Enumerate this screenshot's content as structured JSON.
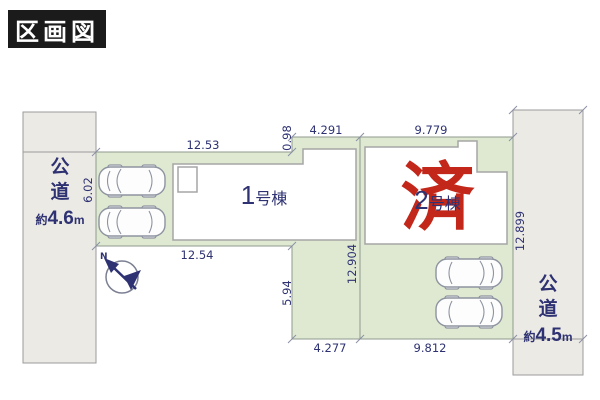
{
  "badge": {
    "label": "区画図"
  },
  "compass": {
    "label": "N"
  },
  "roads": {
    "left": {
      "name": "公道",
      "approx": "約",
      "value": "4.6",
      "unit": "m"
    },
    "right": {
      "name": "公道",
      "approx": "約",
      "value": "4.5",
      "unit": "m"
    }
  },
  "plots": {
    "plot1": {
      "number": "1",
      "suffix": "号棟",
      "dims": {
        "top": "12.53",
        "step": "0.98",
        "top_right": "4.291",
        "left": "6.02",
        "bottom": "12.54",
        "right": "12.904",
        "ext_left": "5.94",
        "ext_bottom": "4.277"
      }
    },
    "plot2": {
      "number": "2",
      "suffix": "号棟",
      "stamp": "済",
      "dims": {
        "top": "9.779",
        "bottom": "9.812",
        "right": "12.899"
      }
    }
  },
  "colors": {
    "plot_green": "#dfe9d1",
    "road_gray": "#eceae5",
    "border_gray": "#9b9b9b",
    "dim_navy": "#2e3272",
    "stamp_red": "#c2271a",
    "badge_black": "#1b1b1b"
  }
}
